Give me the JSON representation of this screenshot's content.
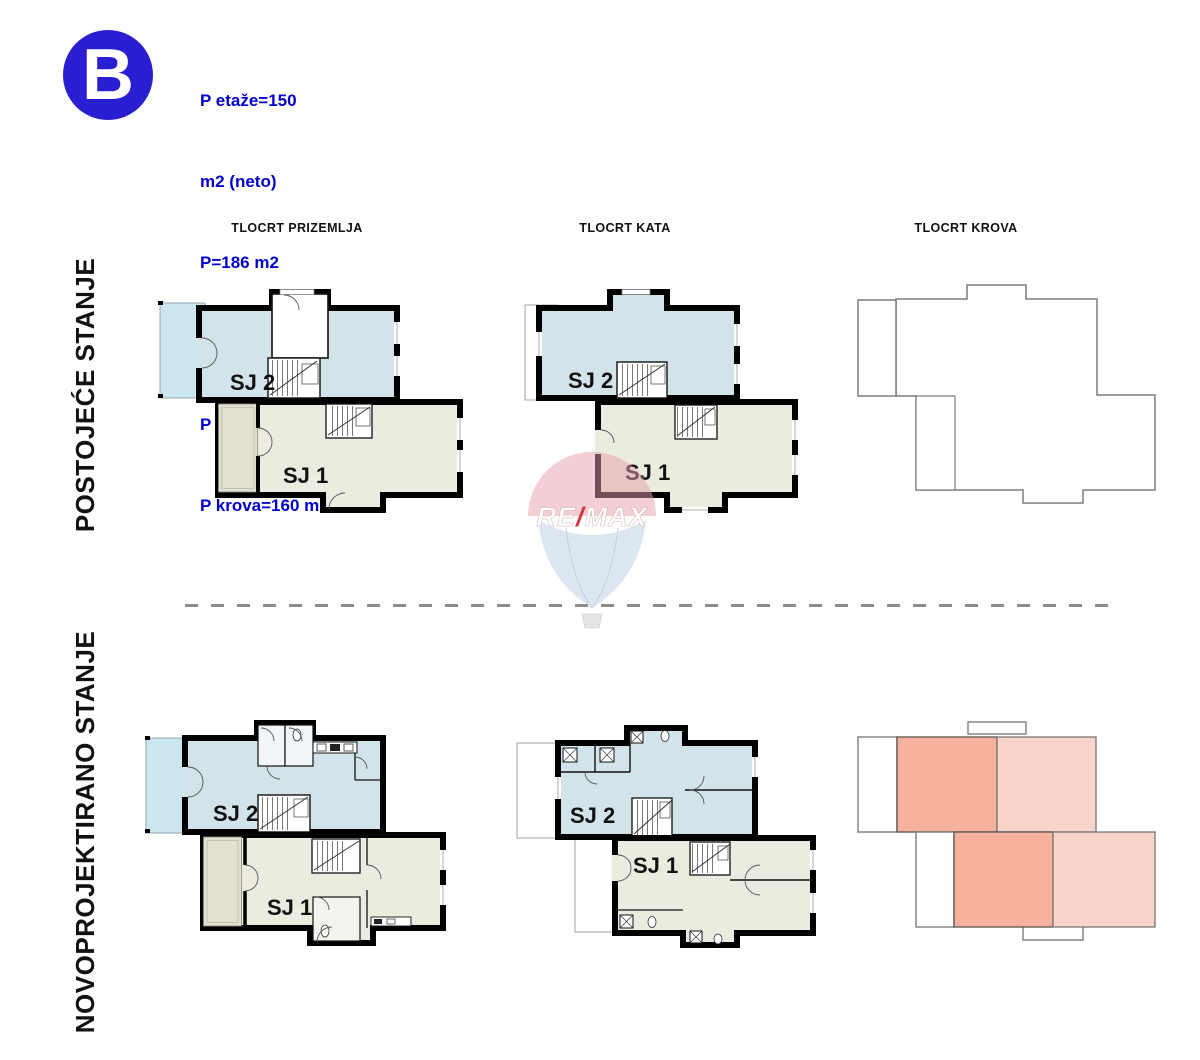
{
  "badge": {
    "letter": "B"
  },
  "info_block": {
    "lines": [
      "P etaže=150",
      "m2 (neto)",
      "P=186 m2",
      "(brutto)",
      "P zidova =245 m2",
      "P krova=160 m2"
    ]
  },
  "headers": {
    "col1": "TLOCRT PRIZEMLJA",
    "col2": "TLOCRT KATA",
    "col3": "TLOCRT KROVA"
  },
  "row_labels": {
    "existing": "POSTOJEĆE STANJE",
    "new": "NOVOPROJEKTIRANO STANJE"
  },
  "unit_labels": {
    "sj1": "SJ 1",
    "sj2": "SJ 2"
  },
  "watermark": {
    "left": "RE",
    "slash": "/",
    "right": "MAX"
  },
  "colors": {
    "badge_blue": "#2a1fd0",
    "info_text_blue": "#0101ce",
    "room_blue": "#d3e3ea",
    "room_beige": "#ecebe0",
    "balcony_blue": "#cbe6ef",
    "terrace_beige": "#e2e1d1",
    "wall_black": "#000000",
    "roof_outline_gray": "#7d7d7d",
    "roof_salmon_dark": "#f7b29e",
    "roof_salmon_light": "#fad3c9",
    "dash_gray": "#8c8c8c",
    "watermark_pink": "#e4a0aa",
    "watermark_blue": "#bfd2e4",
    "watermark_slash_red": "#d03040"
  }
}
